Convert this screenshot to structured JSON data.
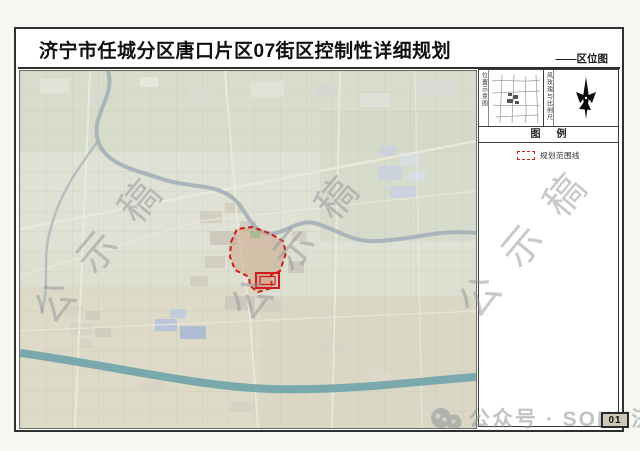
{
  "page": {
    "title_bar": {
      "title": "济宁市任城分区唐口片区07街区控制性详细规划",
      "map_type_label": "——区位图"
    },
    "sheet_number": "01"
  },
  "sidebar": {
    "inset_top_left": {
      "vertical_label": "位置示意图"
    },
    "inset_top_right": {
      "vertical_label": "风玫瑰与比例尺"
    },
    "legend": {
      "header": "图例",
      "items": [
        {
          "symbol": "red-dashed-rectangle",
          "label": "规划范围线"
        }
      ]
    }
  },
  "map": {
    "watermark_text": "公示稿"
  },
  "footer_overlay": {
    "source_text": "公众号 · SOHU济"
  },
  "colors": {
    "accent_red": "#d11c1c",
    "canal_teal": "#74a7ac",
    "watermark_gray": "#90959a",
    "frame_dark": "#2f2f2f"
  }
}
